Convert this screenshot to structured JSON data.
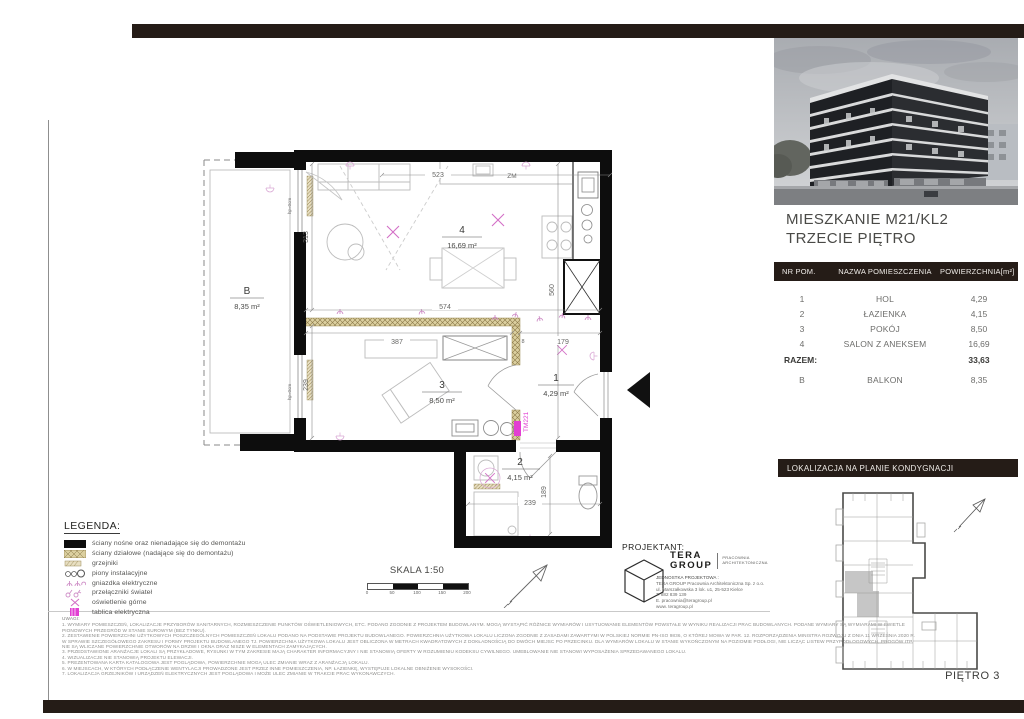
{
  "header": {
    "title_line1": "MIESZKANIE M21/KL2",
    "title_line2": "TRZECIE PIĘTRO"
  },
  "table": {
    "columns": [
      "NR POM.",
      "NAZWA POMIESZCZENIA",
      "POWIERZCHNIA[m²]"
    ],
    "rows": [
      {
        "nr": "1",
        "name": "HOL",
        "area": "4,29"
      },
      {
        "nr": "2",
        "name": "ŁAZIENKA",
        "area": "4,15"
      },
      {
        "nr": "3",
        "name": "POKÓJ",
        "area": "8,50"
      },
      {
        "nr": "4",
        "name": "SALON Z ANEKSEM",
        "area": "16,69"
      }
    ],
    "total_label": "RAZEM:",
    "total_value": "33,63",
    "extra_row": {
      "nr": "B",
      "name": "BALKON",
      "area": "8,35"
    }
  },
  "location": {
    "header": "LOKALIZACJA NA PLANIE KONDYGNACJI",
    "floor_label": "PIĘTRO 3"
  },
  "plan": {
    "rooms": {
      "balcony": {
        "nr": "B",
        "area": "8,35 m²"
      },
      "salon": {
        "nr": "4",
        "area": "16,69 m²"
      },
      "pokoj": {
        "nr": "3",
        "area": "8,50 m²"
      },
      "hol": {
        "nr": "1",
        "area": "4,29 m²"
      },
      "lazienka": {
        "nr": "2",
        "area": "4,15 m²"
      }
    },
    "dims": {
      "kitchen_w": "523",
      "salon_h": "313",
      "salon_w": "574",
      "right_h": "560",
      "pokoj_w": "387",
      "partition": "8",
      "hol_w": "179",
      "pokoj_h": "239",
      "bath_w": "239",
      "bath_h": "189"
    },
    "labels": {
      "zm": "ZM",
      "tm": "TM221",
      "hp": "hp=0cm"
    }
  },
  "legend": {
    "title": "LEGENDA:",
    "items": [
      "ściany nośne oraz nienadające się do demontażu",
      "ściany działowe (nadające się do demontażu)",
      "grzejniki",
      "piony instalacyjne",
      "gniazdka elektryczne",
      "przełączniki świateł",
      "oświetlenie górne",
      "tablica elektryczna"
    ]
  },
  "scale": {
    "label": "SKALA 1:50",
    "ticks": [
      "0",
      "50",
      "100",
      "150",
      "200"
    ]
  },
  "designer": {
    "heading": "PROJEKTANT:",
    "logo_line1": "TERA",
    "logo_line2": "GROUP",
    "logo_sub": "PRACOWNIA ARCHITEKTONICZNA",
    "unit_label": "JEDNOSTKA PROJEKTOWA :",
    "lines": [
      "TERA GROUP Pracownia Architektoniczna Sp. z o.o.",
      "ul. Marszałkowska 3 lok. u1, 25-523 Kielce",
      "T. 882 839 139",
      "E. pracownia@teragroup.pl",
      "www. teragroup.pl"
    ]
  },
  "notes": {
    "title": "UWAGI:",
    "lines": [
      "1. WYMIARY POMIESZCZEŃ, LOKALIZACJE PRZYBORÓW SANITARNYCH, ROZMIESZCZENIE PUNKTÓW OŚWIETLENIOWYCH, ETC. PODANO ZGODNIE Z PROJEKTEM BUDOWLANYM. MOGĄ WYSTĄPIĆ RÓŻNICE WYMIARÓW I USYTUOWANIE ELEMENTÓW POWSTAŁE W WYNIKU REALIZACJI PRAC BUDOWLANYCH. PODANE WYMIARY SĄ WYMIARAMI W ŚWIETLE",
      "PIONOWYCH PRZEGRÓD W STANIE SUROWYM (BEZ TYNKU).",
      "2. ZESTAWIENIE POWIERZCHNI UŻYTKOWYCH POSZCZEGÓLNYCH POMIESZCZEŃ LOKALU PODANO NA PODSTAWIE PROJEKTU BUDOWLANEGO. POWIERZCHNIA UŻYTKOWA LOKALU LICZONA ZGODNIE Z ZASADAMI ZAWARTYMI W POLSKIEJ NORMIE PN-ISO 9836, O KTÓREJ MOWA W PAR. 12. ROZPORZĄDZENIA MINISTRA ROZWOJU Z DNIA 11 WRZEŚNIA 2020 R.",
      "W SPRAWIE SZCZEGÓŁOWEGO ZAKRESU I FORMY PROJEKTU BUDOWLANEGO TJ. POWIERZCHNIA UŻYTKOWA LOKALU JEST OBLICZONA W METRACH KWADRATOWYCH Z DOKŁADNOŚCIĄ DO DWÓCH MIEJSC PO PRZECINKU. DLA WYMIARÓW LOKALU W STANIE WYKOŃCZONYM NA POZIOMIE PODŁOGI, NIE LICZĄC LISTEW PRZYPODŁOGOWYCH, PROGÓW ITP.",
      "NIE SĄ WLICZANE POWIERZCHNIE OTWORÓW NA DRZWI I OKNA ORAZ NISZE W ELEMENTACH ZAMYKAJĄCYCH.",
      "3. PRZEDSTAWIONE ARANŻACJE LOKALI SĄ PRZYKŁADOWE, RYSUNKI W TYM ZAKRESIE MAJĄ CHARAKTER INFORMACYJNY I NIE STANOWIĄ OFERTY W ROZUMIENIU KODEKSU CYWILNEGO. UMEBLOWANIE NIE STANOWI WYPOSAŻENIA SPRZEDAWANEGO LOKALU.",
      "4. WIZUALIZACJE NIE STANOWIĄ PROJEKTU ELEWACJI.",
      "5. PREZENTOWANA KARTA KATALOGOWA JEST POGLĄDOWA, POWIERZCHNIE MOGĄ ULEC ZMIANIE WRAZ Z ARANŻACJĄ LOKALU.",
      "6. W MIEJSCACH, W KTÓRYCH PODŁĄCZENIE WENTYLACJI PROWADZONE JEST PRZEZ INNE POMIESZCZENIA, NP. ŁAZIENKĘ, WYSTĘPUJE LOKALNE OBNIŻENIE WYSOKOŚCI.",
      "7. LOKALIZACJA GRZEJNIKÓW I URZĄDZEŃ ELEKTRYCZNYCH JEST POGLĄDOWA I MOŻE ULEC ZMIANIE W TRAKCIE PRAC WYKONAWCZYCH."
    ]
  },
  "colors": {
    "bar_dark": "#251c17",
    "magenta": "#e23fd2",
    "pink_symbols": "#d36fc6",
    "partition_tan": "#dbcf9f"
  }
}
